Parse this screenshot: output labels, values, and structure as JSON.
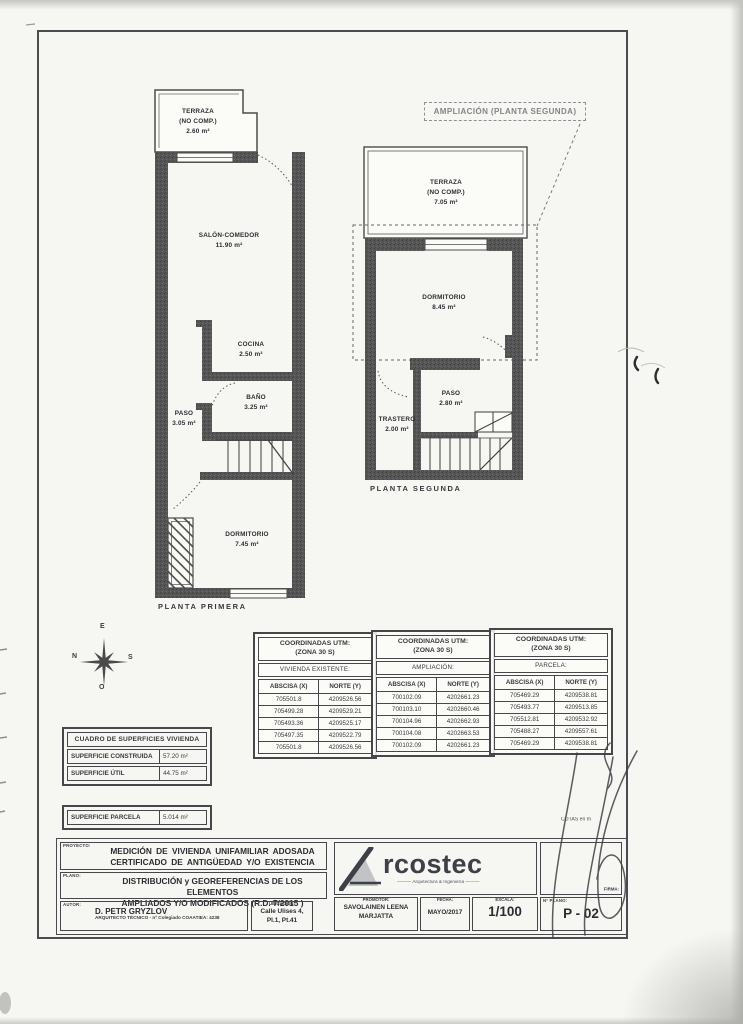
{
  "page": {
    "paper": "#f6f6f2",
    "ink": "#3c3c40",
    "wall": "#565656"
  },
  "plans": {
    "primera": {
      "caption": "PLANTA PRIMERA",
      "rooms": {
        "terraza": {
          "name": "TERRAZA",
          "note": "(NO COMP.)",
          "area": "2.60 m²"
        },
        "salon": {
          "name": "SALÓN-COMEDOR",
          "area": "11.90 m²"
        },
        "cocina": {
          "name": "COCINA",
          "area": "2.50 m²"
        },
        "bano": {
          "name": "BAÑO",
          "area": "3.25 m²"
        },
        "paso": {
          "name": "PASO",
          "area": "3.05 m²"
        },
        "dormitorio": {
          "name": "DORMITORIO",
          "area": "7.45 m²"
        }
      }
    },
    "segunda": {
      "caption": "PLANTA SEGUNDA",
      "annotation": "AMPLIACIÓN (PLANTA SEGUNDA)",
      "rooms": {
        "terraza": {
          "name": "TERRAZA",
          "note": "(NO COMP.)",
          "area": "7.05 m²"
        },
        "dormitorio": {
          "name": "DORMITORIO",
          "area": "8.45 m²"
        },
        "paso": {
          "name": "PASO",
          "area": "2.80 m²"
        },
        "trastero": {
          "name": "TRASTERO",
          "area": "2.00 m²"
        }
      }
    }
  },
  "compass": {
    "top": "E",
    "left": "N",
    "right": "S",
    "bottom": "O"
  },
  "coordinate_tables": [
    {
      "title_line1": "COORDINADAS UTM:",
      "title_line2": "(ZONA 30 S)",
      "subtitle": "VIVIENDA EXISTENTE:",
      "headers": [
        "ABSCISA (X)",
        "NORTE (Y)"
      ],
      "rows": [
        [
          "705501.8",
          "4209526.56"
        ],
        [
          "705499.28",
          "4209529.21"
        ],
        [
          "705493.36",
          "4209525.17"
        ],
        [
          "705497.35",
          "4209522.79"
        ],
        [
          "705501.8",
          "4209526.56"
        ]
      ]
    },
    {
      "title_line1": "COORDINADAS UTM:",
      "title_line2": "(ZONA 30 S)",
      "subtitle": "AMPLIACIÓN:",
      "headers": [
        "ABSCISA (X)",
        "NORTE (Y)"
      ],
      "rows": [
        [
          "700102.09",
          "4202661.23"
        ],
        [
          "700103.10",
          "4202660.46"
        ],
        [
          "700104.96",
          "4202662.93"
        ],
        [
          "700104.08",
          "4202663.53"
        ],
        [
          "700102.09",
          "4202661.23"
        ]
      ]
    },
    {
      "title_line1": "COORDINADAS UTM:",
      "title_line2": "(ZONA 30 S)",
      "subtitle": "PARCELA:",
      "headers": [
        "ABSCISA (X)",
        "NORTE (Y)"
      ],
      "rows": [
        [
          "705469.29",
          "4209538.81"
        ],
        [
          "705493.77",
          "4209513.85"
        ],
        [
          "705512.81",
          "4209532.92"
        ],
        [
          "705488.27",
          "4209557.61"
        ],
        [
          "705469.29",
          "4209538.81"
        ]
      ]
    }
  ],
  "surfaces": {
    "title": "CUADRO DE SUPERFICIES VIVIENDA",
    "rows": [
      [
        "SUPERFICIE CONSTRUIDA",
        "57.20 m²"
      ],
      [
        "SUPERFICIE ÚTIL",
        "44.75 m²"
      ]
    ],
    "parcel_label": "SUPERFICIE PARCELA",
    "parcel_value": "5.014 m²"
  },
  "notes": {
    "cotas": "COTAS en m"
  },
  "title_block": {
    "proyecto_label": "PROYECTO:",
    "proyecto_line1": "MEDICIÓN DE VIVIENDA UNIFAMILIAR ADOSADA",
    "proyecto_line2": "CERTIFICADO DE ANTIGÜEDAD Y/O EXISTENCIA",
    "plano_label": "PLANO:",
    "plano_line1": "DISTRIBUCIÓN y GEOREFERENCIAS DE LOS ELEMENTOS",
    "plano_line2": "AMPLIADOS Y/O MODIFICADOS (R.D. 7/2015 )",
    "autor_label": "AUTOR:",
    "autor_name": "D. PETR GRYZLOV",
    "autor_detail": "ARQUITECTO TÉCNICO - nº Colegiado COAATIEA: 4238",
    "ubicacion_label": "UBICACIÓN:",
    "ubicacion_line1": "Calle Ulises 4,",
    "ubicacion_line2": "Pl.1, Pt.41",
    "promotor_label": "PROMOTOR:",
    "promotor_line1": "SAVOLAINEN LEENA",
    "promotor_line2": "MARJATTA",
    "fecha_label": "FECHA:",
    "fecha_value": "MAYO/2017",
    "escala_label": "ESCALA:",
    "escala_value": "1/100",
    "nplano_label": "Nº PLANO:",
    "nplano_value": "P - 02",
    "firma_label": "FIRMA:",
    "logo_text": "rcostec",
    "logo_tagline": "Arquitectura & Ingeniería"
  }
}
